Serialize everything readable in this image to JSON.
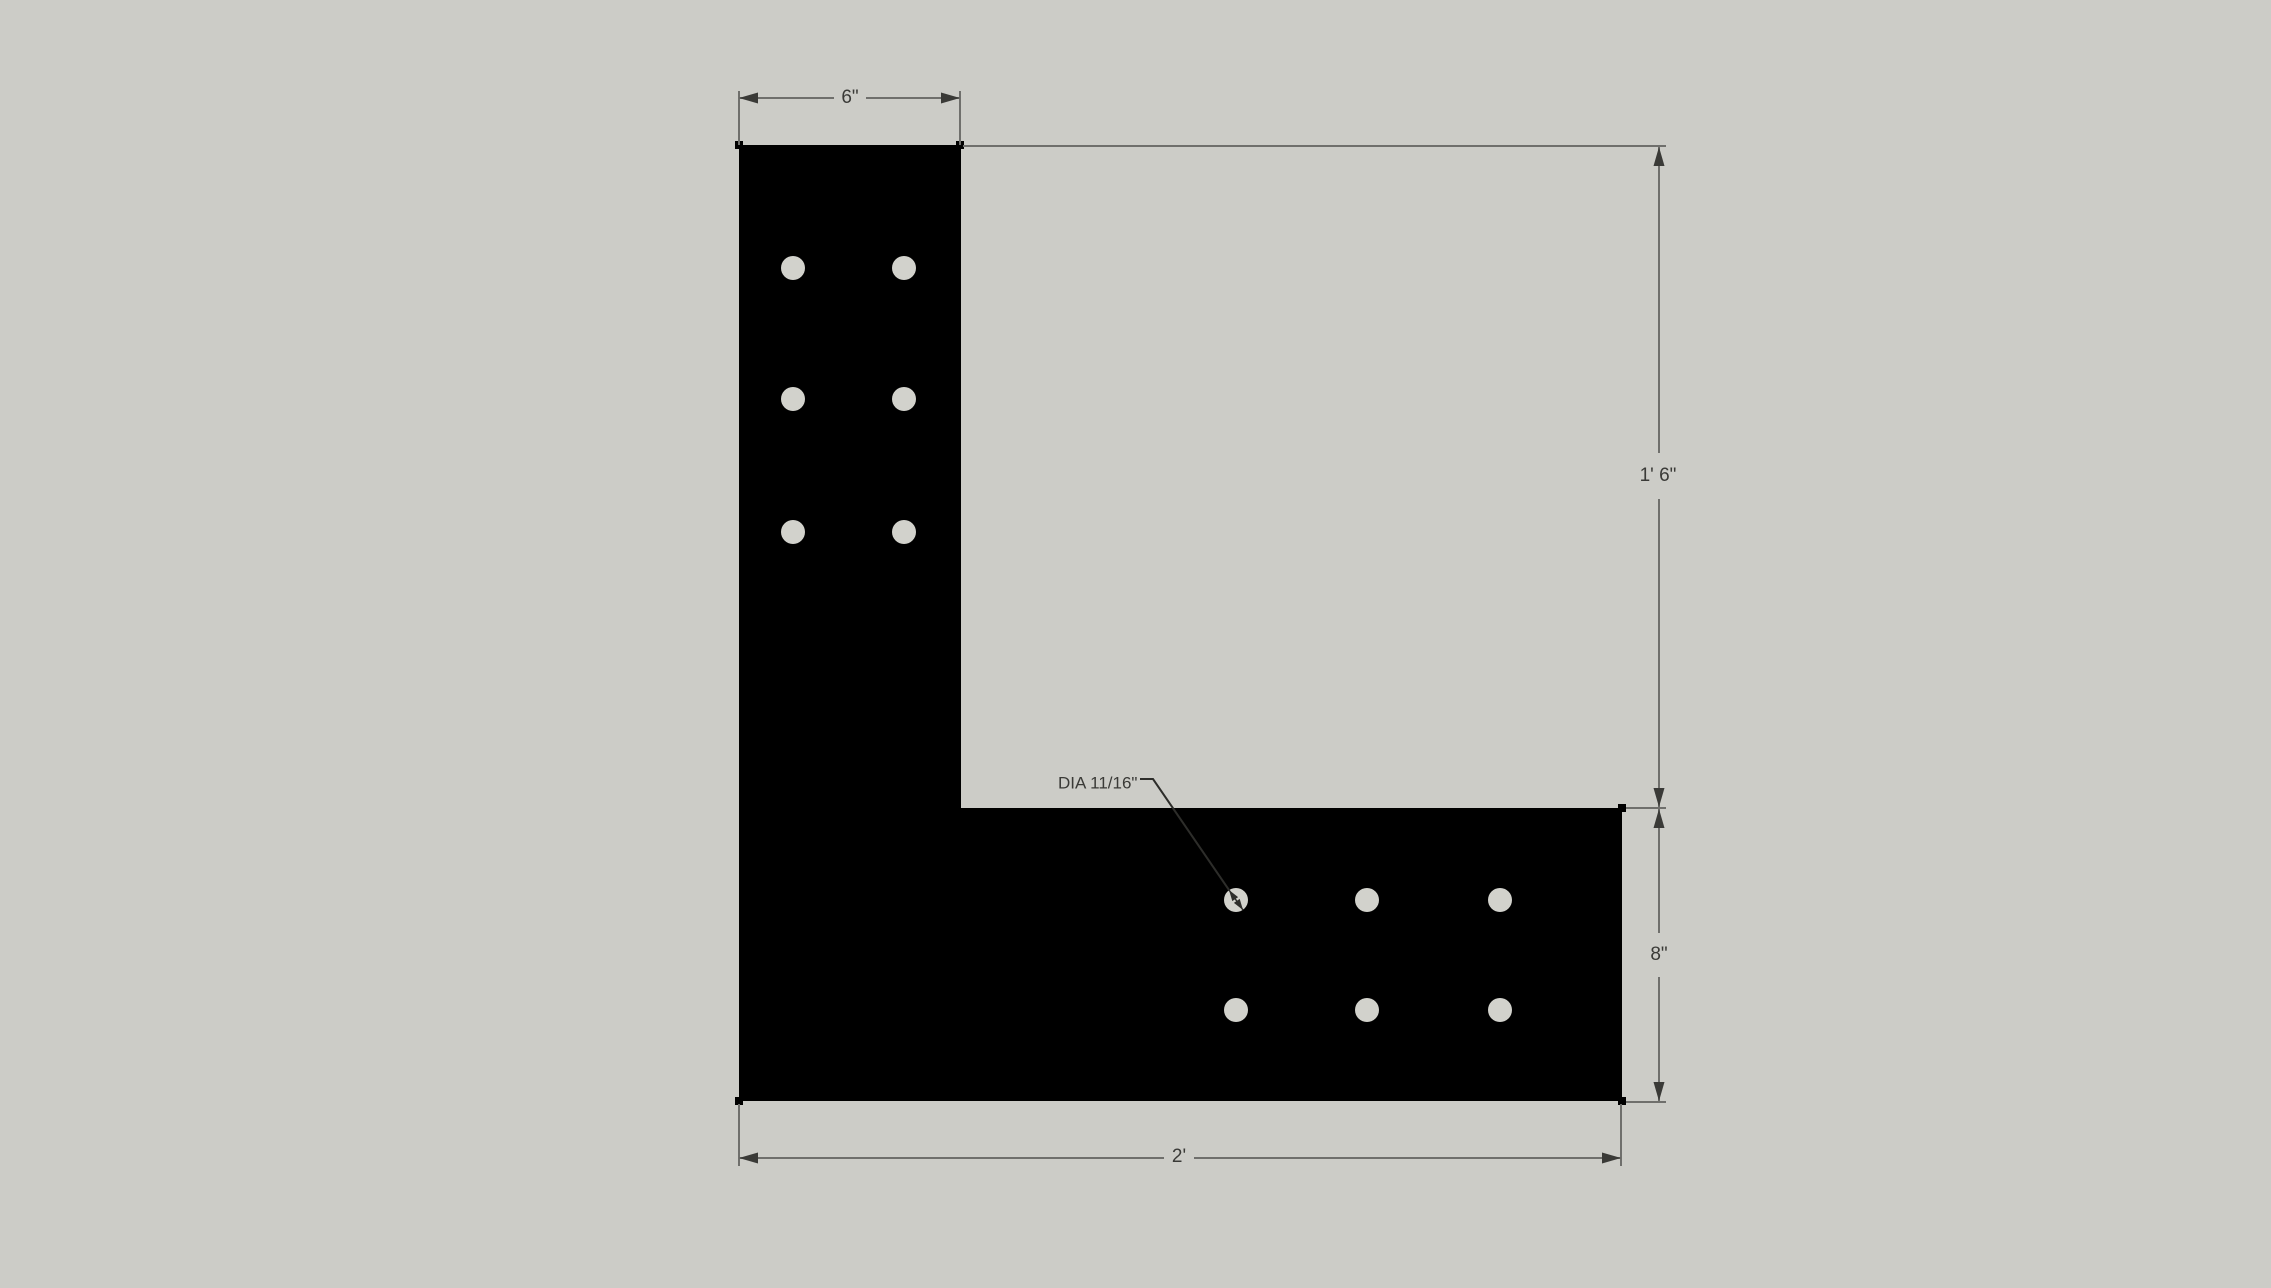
{
  "colors": {
    "background": "#ccccc7",
    "shape": "#000000",
    "hole": "#d2d2cc",
    "dim_line": "#6f6f6c",
    "dim_text": "#3a3a37",
    "arrow": "#3a3a37",
    "leader": "#2d2d2a",
    "marker": "#000000"
  },
  "dimensions": {
    "top_width": {
      "label": "6\""
    },
    "right_height": {
      "label": "1' 6\""
    },
    "arm_height": {
      "label": "8\""
    },
    "bottom_width": {
      "label": "2'"
    },
    "hole_callout": {
      "label": "DIA 11/16\""
    }
  }
}
